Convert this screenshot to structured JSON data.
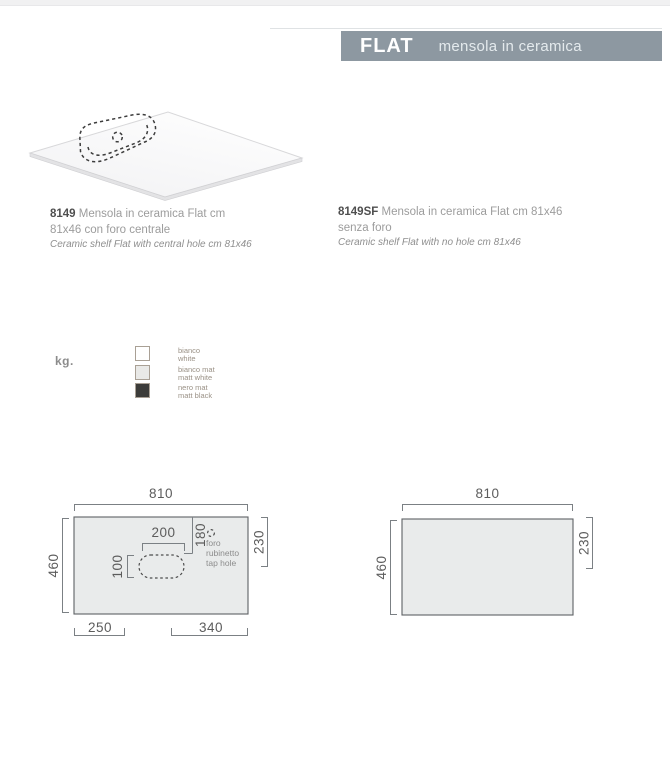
{
  "header": {
    "title": "FLAT",
    "subtitle": "mensola in ceramica",
    "bar_color": "#8d98a1"
  },
  "products": [
    {
      "code": "8149",
      "desc_it_1": "Mensola in ceramica Flat cm",
      "desc_it_2": "81x46 con foro centrale",
      "desc_en": "Ceramic shelf Flat with central hole cm 81x46"
    },
    {
      "code": "8149SF",
      "desc_it_1": "Mensola in ceramica Flat cm 81x46",
      "desc_it_2": "senza foro",
      "desc_en": "Ceramic shelf Flat with no hole cm 81x46"
    }
  ],
  "weight_legend": {
    "label": "kg.",
    "finishes": [
      {
        "name_it": "bianco",
        "name_en": "white",
        "color": "#ffffff"
      },
      {
        "name_it": "bianco mat",
        "name_en": "matt white",
        "color": "#e9e9e7"
      },
      {
        "name_it": "nero mat",
        "name_en": "matt black",
        "color": "#3c3c3a"
      }
    ]
  },
  "drawings": {
    "shelf_fill": "#e9ebeb",
    "left": {
      "dim_width": "810",
      "dim_height": "460",
      "dim_right": "230",
      "dim_hole_width": "200",
      "dim_hole_offset": "180",
      "dim_hole_height": "100",
      "dim_bottom_left": "250",
      "dim_bottom_right": "340",
      "tap_hole_label": [
        "foro",
        "rubinetto",
        "tap hole"
      ]
    },
    "right": {
      "dim_width": "810",
      "dim_height": "460",
      "dim_right": "230"
    }
  }
}
